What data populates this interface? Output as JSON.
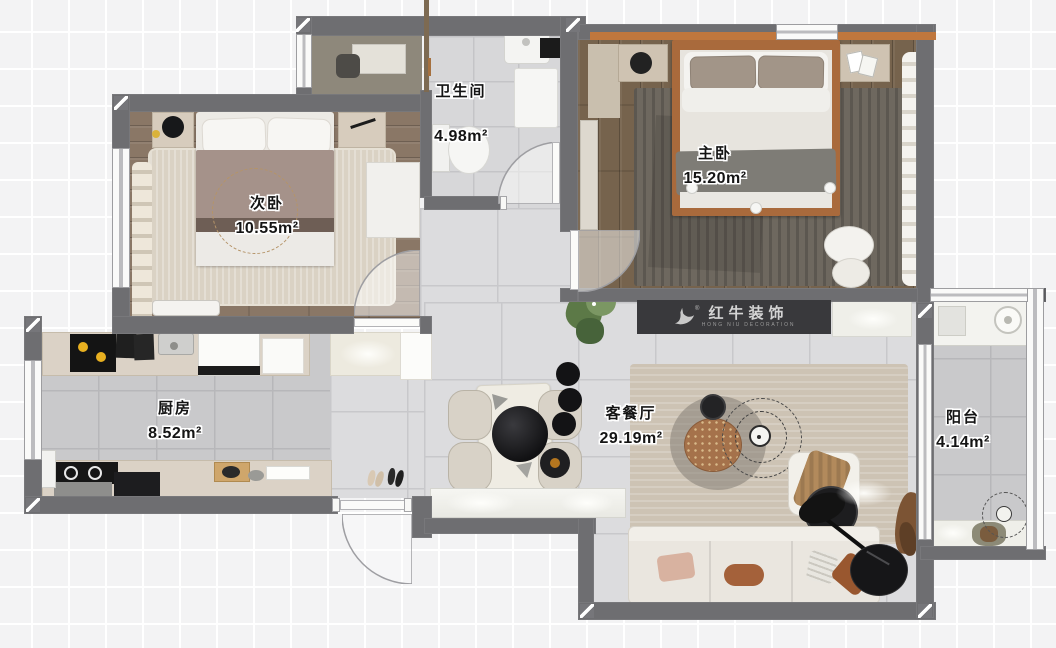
{
  "rooms": [
    {
      "id": "bathroom",
      "name": "卫生间",
      "area": "4.98m²"
    },
    {
      "id": "master-bedroom",
      "name": "主卧",
      "area": "15.20m²"
    },
    {
      "id": "second-bedroom",
      "name": "次卧",
      "area": "10.55m²"
    },
    {
      "id": "kitchen",
      "name": "厨房",
      "area": "8.52m²"
    },
    {
      "id": "living-dining",
      "name": "客餐厅",
      "area": "29.19m²"
    },
    {
      "id": "balcony",
      "name": "阳台",
      "area": "4.14m²"
    }
  ],
  "watermark": {
    "brand": "红牛装饰",
    "subtitle": "HONG NIU DECORATION",
    "registered": "®"
  },
  "colors": {
    "wall": "#6e6e71",
    "wood_accent": "#c0773d",
    "watermark_bg": "#39393c",
    "watermark_text": "#d4d4d4",
    "flame_yellow": "#e8b020"
  }
}
